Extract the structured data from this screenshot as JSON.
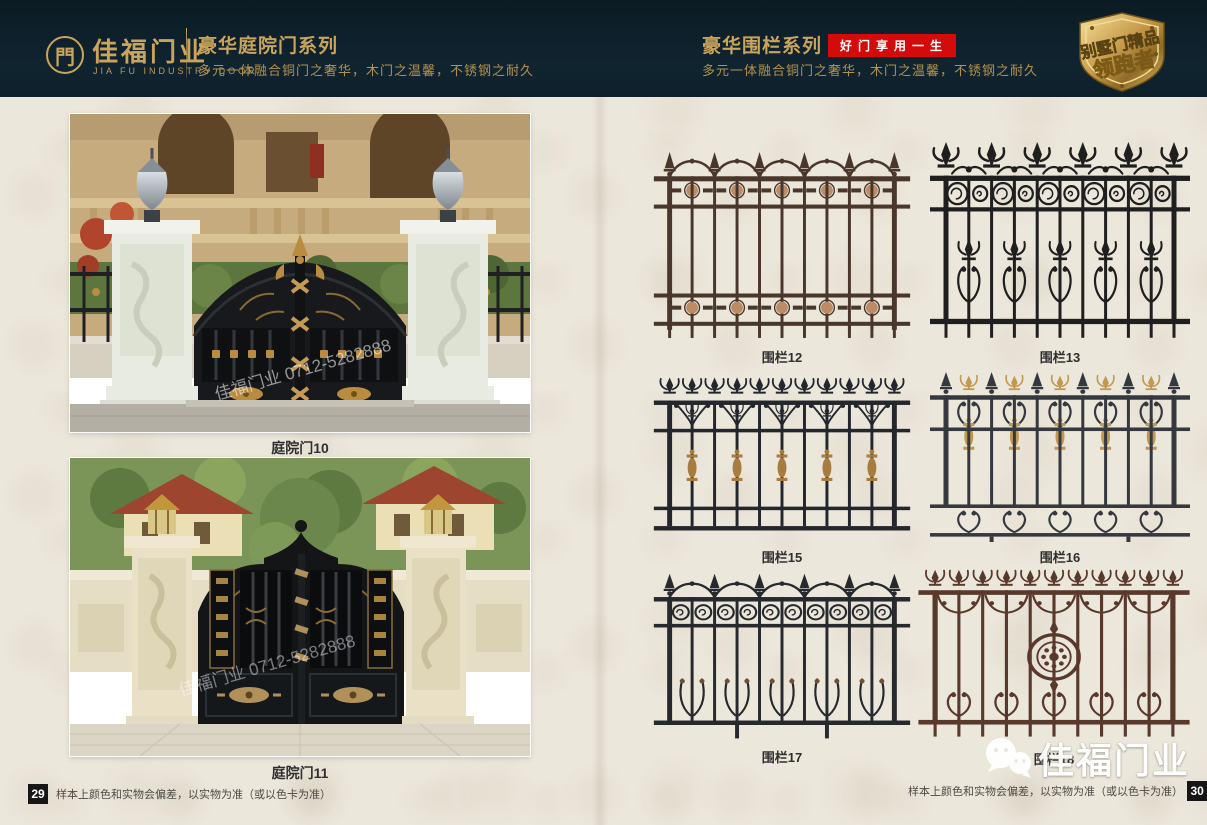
{
  "header": {
    "logo": {
      "glyph": "門",
      "brand_cn": "佳福门业",
      "brand_en": "JIA FU INDUSTRY DOOR"
    },
    "left_series": {
      "title": "豪华庭院门系列",
      "subtitle": "多元一体融合铜门之奢华，木门之温馨，不锈钢之耐久"
    },
    "right_series": {
      "title": "豪华围栏系列",
      "badge": "好门享用一生",
      "subtitle": "多元一体融合铜门之奢华，木门之温馨，不锈钢之耐久"
    },
    "emblem": {
      "line1": "别墅门精品",
      "line2": "领跑者"
    }
  },
  "left_page": {
    "photos": [
      {
        "caption": "庭院门10",
        "watermark": "佳福门业 0712-5282888"
      },
      {
        "caption": "庭院门11",
        "watermark": "佳福门业 0712-5282888"
      }
    ],
    "page_number": "29",
    "footnote": "样本上颜色和实物会偏差，以实物为准（或以色卡为准）"
  },
  "right_page": {
    "fences": [
      {
        "caption": "围栏12",
        "style": "rosette-bands",
        "frame_color": "#4a372c",
        "accent_color": "#bd8b66"
      },
      {
        "caption": "围栏13",
        "style": "circle-fleur",
        "frame_color": "#1f1f1f",
        "accent_color": "#1f1f1f"
      },
      {
        "caption": "围栏15",
        "style": "fleur-gold",
        "frame_color": "#23272d",
        "accent_color": "#a87c3e"
      },
      {
        "caption": "围栏16",
        "style": "gold-finial",
        "frame_color": "#35393f",
        "accent_color": "#c0984f"
      },
      {
        "caption": "围栏17",
        "style": "scroll",
        "frame_color": "#26292d",
        "accent_color": "#6e5038"
      },
      {
        "caption": "围栏18",
        "style": "medallion",
        "frame_color": "#59392c",
        "accent_color": "#6e4534"
      }
    ],
    "page_number": "30",
    "footnote": "样本上颜色和实物会偏差，以实物为准（或以色卡为准）",
    "watermark_logo": "佳福门业"
  }
}
